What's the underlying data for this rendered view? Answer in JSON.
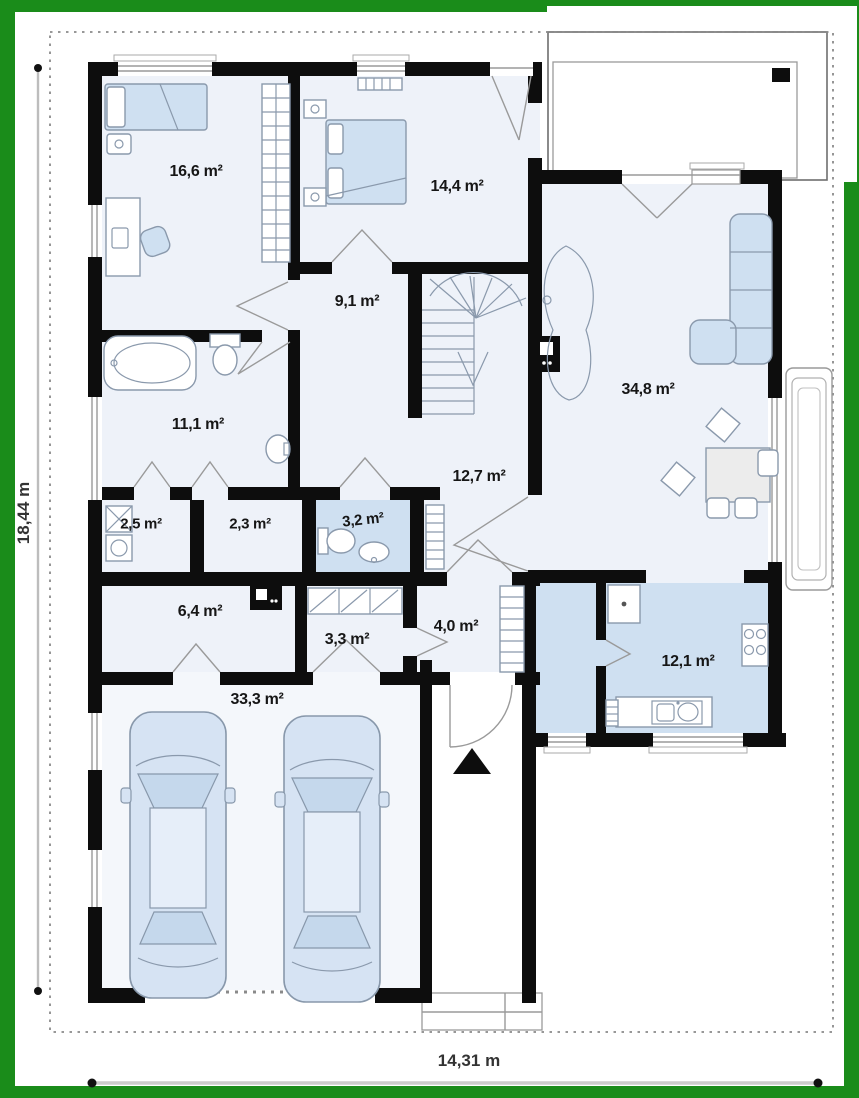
{
  "colors": {
    "frame-green": "#1a8c1a",
    "wall-black": "#0d0d0d",
    "room-fill": "#eef2f9",
    "garage-fill": "#f4f7fb",
    "accent-blue": "#cfe0f1",
    "stroke-gray": "#8a99ac",
    "dim-gray": "#bdbdbd"
  },
  "dimensions": {
    "height_label": "18,44 m",
    "width_label": "14,31 m"
  },
  "rooms": [
    {
      "id": "bedroom-1",
      "label": "16,6 m²"
    },
    {
      "id": "bedroom-2",
      "label": "14,4 m²"
    },
    {
      "id": "hall-upper",
      "label": "9,1 m²"
    },
    {
      "id": "bathroom",
      "label": "11,1 m²"
    },
    {
      "id": "laundry",
      "label": "2,5 m²"
    },
    {
      "id": "closet",
      "label": "2,3 m²"
    },
    {
      "id": "wc",
      "label": "3,2 m²"
    },
    {
      "id": "hall-lower",
      "label": "12,7 m²"
    },
    {
      "id": "living-room",
      "label": "34,8 m²"
    },
    {
      "id": "utility",
      "label": "6,4 m²"
    },
    {
      "id": "storage",
      "label": "3,3 m²"
    },
    {
      "id": "vestibule",
      "label": "4,0 m²"
    },
    {
      "id": "garage",
      "label": "33,3 m²"
    },
    {
      "id": "kitchen",
      "label": "12,1 m²"
    }
  ]
}
